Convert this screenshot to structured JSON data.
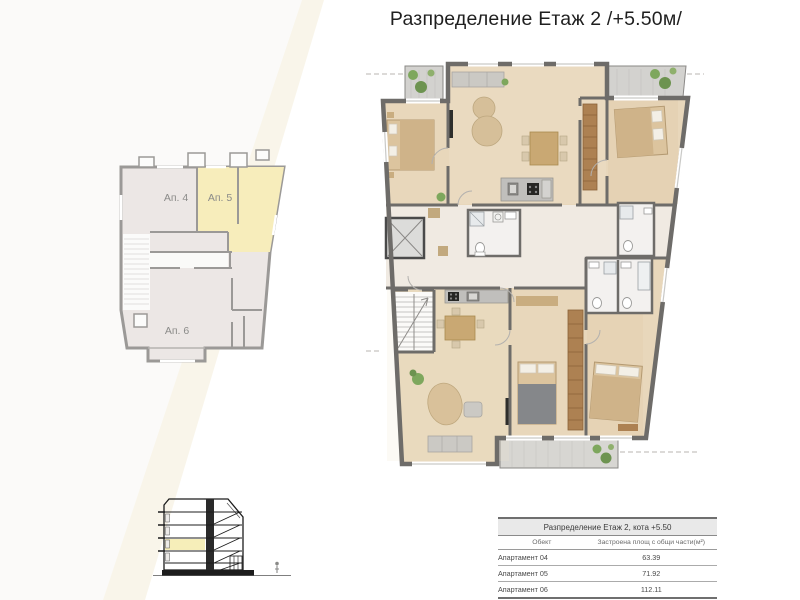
{
  "page": {
    "title": "Разпределение Етаж 2 /+5.50м/"
  },
  "overview_plan": {
    "apartments": [
      {
        "label": "Ап. 4",
        "highlighted": false
      },
      {
        "label": "Ап. 5",
        "highlighted": true
      },
      {
        "label": "Ап. 6",
        "highlighted": false
      }
    ]
  },
  "area_table": {
    "title": "Разпределение Етаж 2, кота +5.50",
    "columns": [
      "Обект",
      "Застроена площ с общи части(м²)"
    ],
    "rows": [
      {
        "object": "Апартамент 04",
        "area": "63.39"
      },
      {
        "object": "Апартамент 05",
        "area": "71.92"
      },
      {
        "object": "Апартамент 06",
        "area": "112.11"
      }
    ]
  },
  "colors": {
    "highlight_yellow": "#f7edbb",
    "floor_wood": "#e8d7bb",
    "wall_gray": "#6e6c69",
    "overview_room": "#ece7e5",
    "balcony_gray": "#d3d2cf",
    "plant_green": "#7ea75d"
  }
}
